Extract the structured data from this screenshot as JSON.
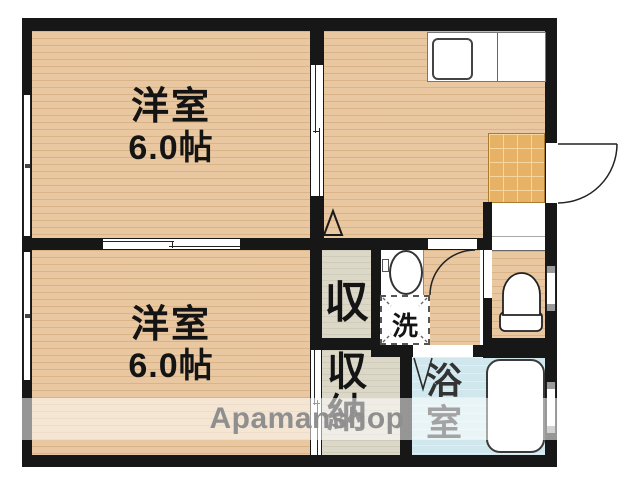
{
  "plan": {
    "rooms": {
      "western_top": {
        "label": "洋室",
        "size": "6.0帖"
      },
      "western_bottom": {
        "label": "洋室",
        "size": "6.0帖"
      },
      "closet": {
        "label": "収"
      },
      "storage": {
        "char1": "収",
        "char2": "納"
      },
      "laundry": {
        "label": "洗"
      },
      "bathroom": {
        "char1": "浴",
        "char2": "室"
      }
    },
    "watermark": "Apamanshop",
    "colors": {
      "wall": "#171717",
      "wood": "#e9c7a0",
      "closet-floor": "#dcd8c8",
      "tile": "#e8b266",
      "tile-grout": "#f4d79f",
      "bath": "#cfe7ed",
      "watermark-text": "#8f8f8f"
    }
  }
}
